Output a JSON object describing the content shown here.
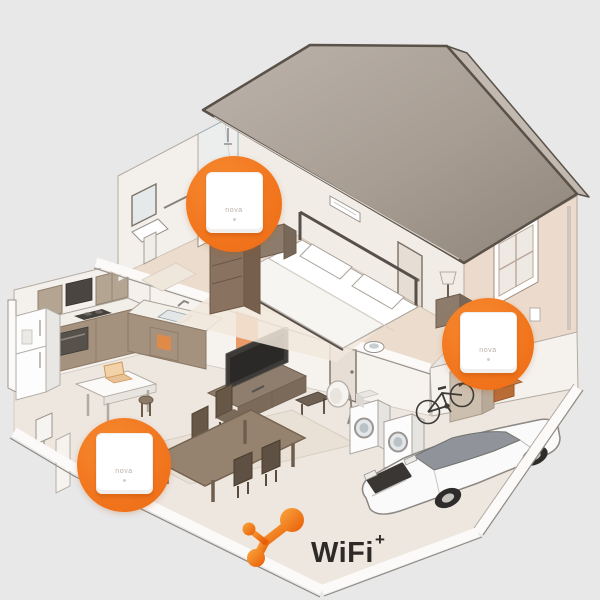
{
  "scene": {
    "background_color": "#e8e8e9",
    "accent_orange": "#f2771f",
    "roof_color": "#a79d93"
  },
  "nodes": {
    "items": [
      {
        "id": "upstairs-node",
        "label": "nova"
      },
      {
        "id": "ground-floor-node",
        "label": "nova"
      },
      {
        "id": "garage-node",
        "label": "nova"
      }
    ]
  },
  "logo": {
    "brand": "WiFi",
    "superscript": "+"
  }
}
